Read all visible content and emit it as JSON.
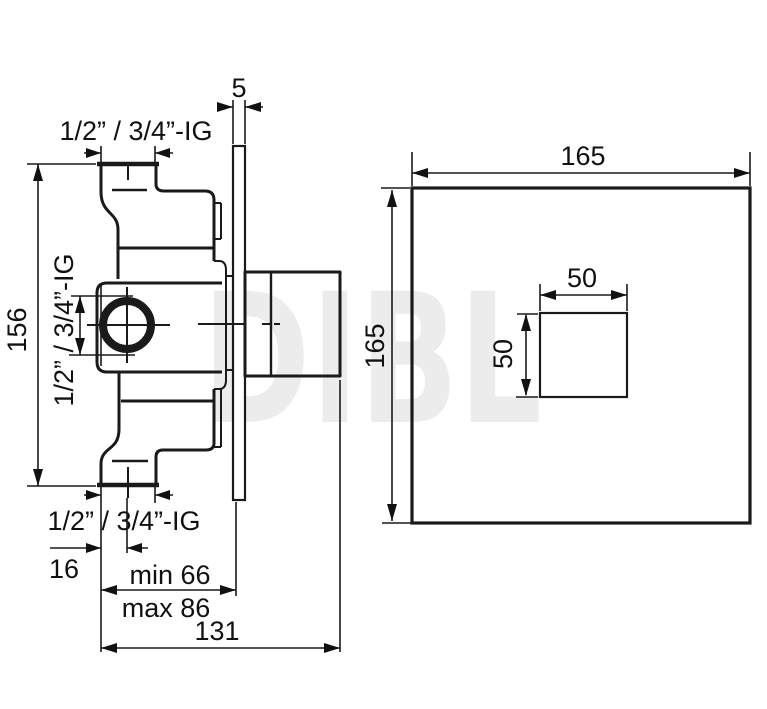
{
  "side_view": {
    "plate_thickness": "5",
    "top_port_thread": "1/2” / 3/4”-IG",
    "side_port_thread": "1/2” / 3/4”-IG",
    "bottom_port_thread": "1/2” / 3/4”-IG",
    "body_height": "156",
    "port_center_offset": "16",
    "depth_min": "min 66",
    "depth_max": "max 86",
    "overall_depth": "131"
  },
  "front_view": {
    "plate_width": "165",
    "plate_height": "165",
    "handle_width": "50",
    "handle_height": "50"
  },
  "watermark": "DIBL",
  "colors": {
    "line": "#1a1a1a",
    "dim": "#111111",
    "watermark": "#ececec",
    "background": "#ffffff"
  }
}
